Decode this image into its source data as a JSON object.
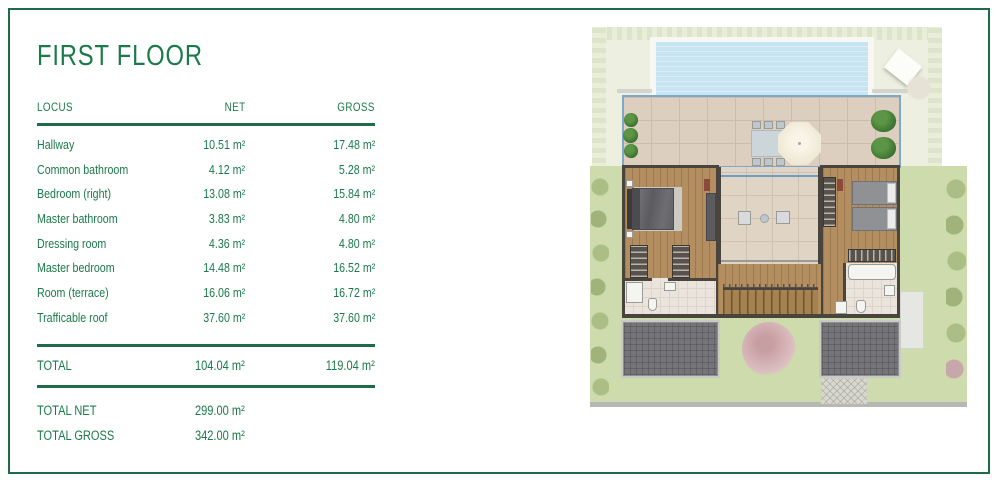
{
  "title": "FIRST FLOOR",
  "table": {
    "headers": {
      "locus": "LOCUS",
      "net": "NET",
      "gross": "GROSS"
    },
    "rows": [
      {
        "locus": "Hallway",
        "net": "10.51 m²",
        "gross": "17.48 m²"
      },
      {
        "locus": "Common bathroom",
        "net": "4.12 m²",
        "gross": "5.28 m²"
      },
      {
        "locus": "Bedroom (right)",
        "net": "13.08 m²",
        "gross": "15.84 m²"
      },
      {
        "locus": "Master bathroom",
        "net": "3.83 m²",
        "gross": "4.80 m²"
      },
      {
        "locus": "Dressing room",
        "net": "4.36 m²",
        "gross": "4.80 m²"
      },
      {
        "locus": "Master bedroom",
        "net": "14.48 m²",
        "gross": "16.52 m²"
      },
      {
        "locus": "Room (terrace)",
        "net": "16.06 m²",
        "gross": "16.72 m²"
      },
      {
        "locus": "Trafficable roof",
        "net": "37.60 m²",
        "gross": "37.60 m²"
      }
    ],
    "total": {
      "label": "TOTAL",
      "net": "104.04 m²",
      "gross": "119.04 m²"
    },
    "summary": [
      {
        "label": "TOTAL NET",
        "value": "299.00 m²"
      },
      {
        "label": "TOTAL GROSS",
        "value": "342.00 m²"
      }
    ]
  },
  "colors": {
    "accent_green": "#1b7a4a",
    "rule_green": "#1d6b49",
    "frame_border": "#1d6b49",
    "lawn": "#cedbac",
    "lawn_faded": "#edf0e0",
    "pool_water": "#c6e4f2",
    "terrace_tile": "#dccfbf",
    "railing_blue": "#7ea7c8",
    "wood_floor": "#b28e60",
    "wall": "#4a443f",
    "roof_deck": "#757579",
    "tree_pink": "#d2aeb1"
  }
}
